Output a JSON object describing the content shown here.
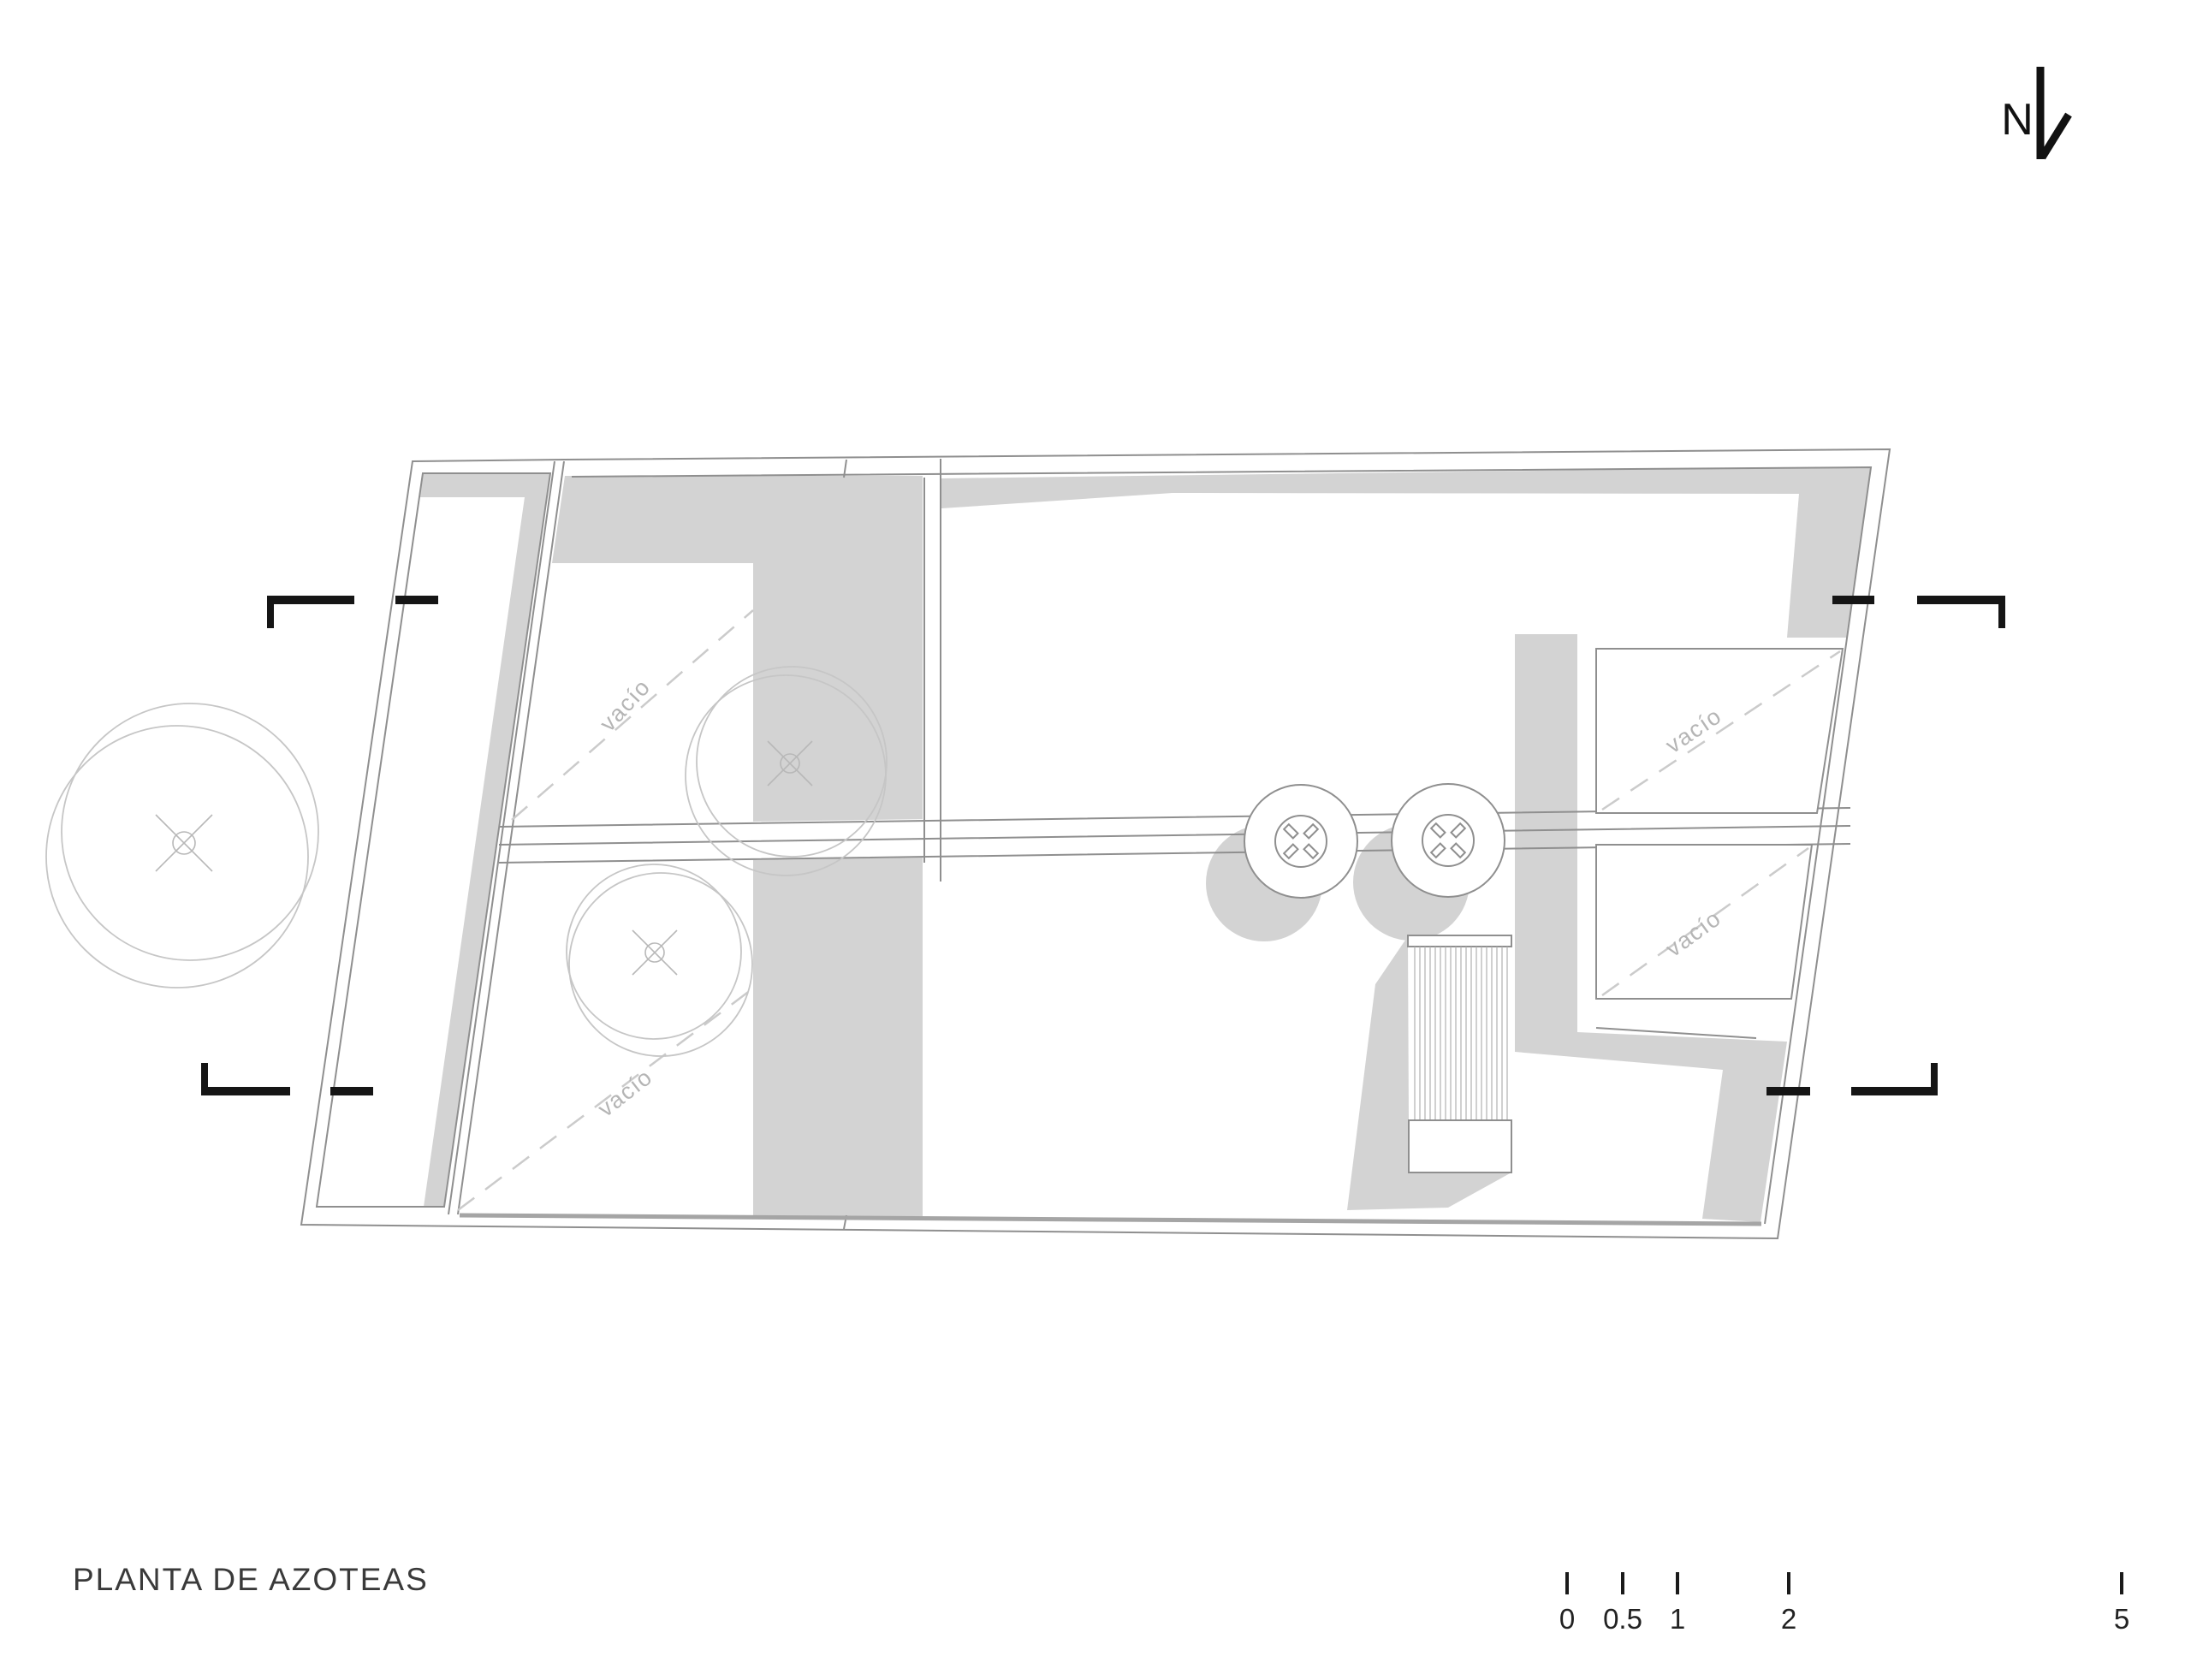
{
  "title": "PLANTA DE AZOTEAS",
  "north_arrow": {
    "label": "N"
  },
  "scale_bar": {
    "ticks": [
      "0",
      "0.5",
      "1",
      "2",
      "5"
    ]
  },
  "plan": {
    "void_labels": [
      "vacío",
      "vacío",
      "vacío",
      "vacío"
    ]
  },
  "colors": {
    "background": "#ffffff",
    "shadow_fill": "#d3d3d3",
    "wall_line": "#8f8f8f",
    "tree_line": "#c6c6c6",
    "dashed_line": "#cbcbcb",
    "muted_text": "#b5b5b5",
    "title_text": "#3a3a3a",
    "black_marks": "#151515"
  }
}
